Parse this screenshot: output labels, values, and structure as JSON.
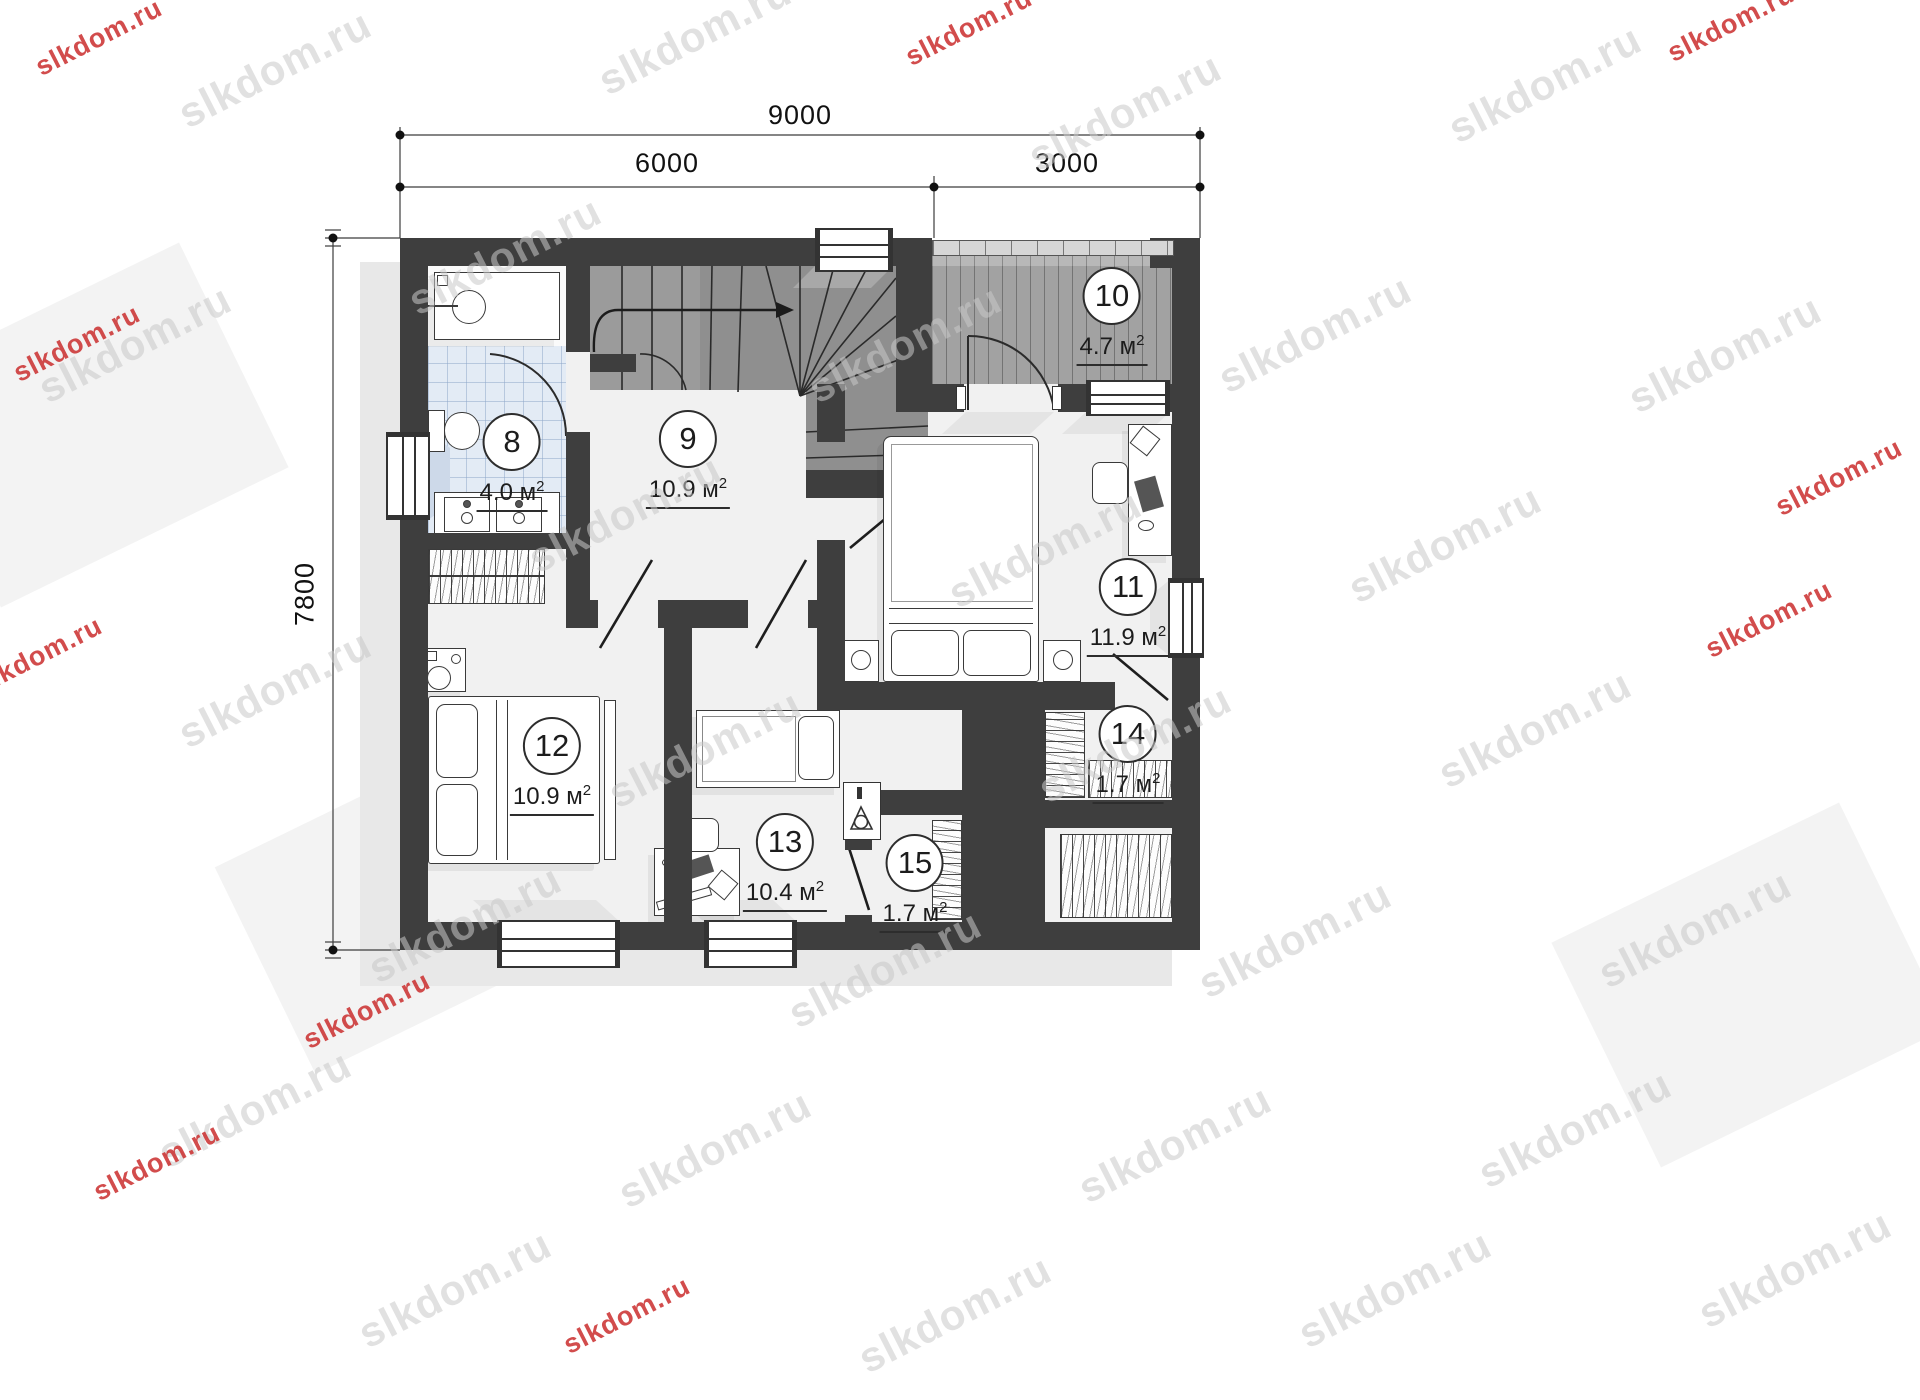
{
  "watermark": {
    "text": "slkdom.ru"
  },
  "dimensions": {
    "total_width": "9000",
    "left_width": "6000",
    "right_width": "3000",
    "height": "7800"
  },
  "labels": {
    "unit": " м",
    "sup": "2"
  },
  "rooms": [
    {
      "number": "8",
      "area": "4.0"
    },
    {
      "number": "9",
      "area": "10.9"
    },
    {
      "number": "10",
      "area": "4.7"
    },
    {
      "number": "11",
      "area": "11.9"
    },
    {
      "number": "12",
      "area": "10.9"
    },
    {
      "number": "13",
      "area": "10.4"
    },
    {
      "number": "14",
      "area": "1.7"
    },
    {
      "number": "15",
      "area": "1.7"
    }
  ],
  "colors": {
    "wall": "#3e3e3e",
    "stairs": "#8f8f8f",
    "balcony_deck": "#a2a2a2",
    "bathroom_tile": "#e3ebf5",
    "floor": "#f1f1f1",
    "watermark_gray": "#c9c9c9",
    "watermark_red": "#cc3434"
  }
}
